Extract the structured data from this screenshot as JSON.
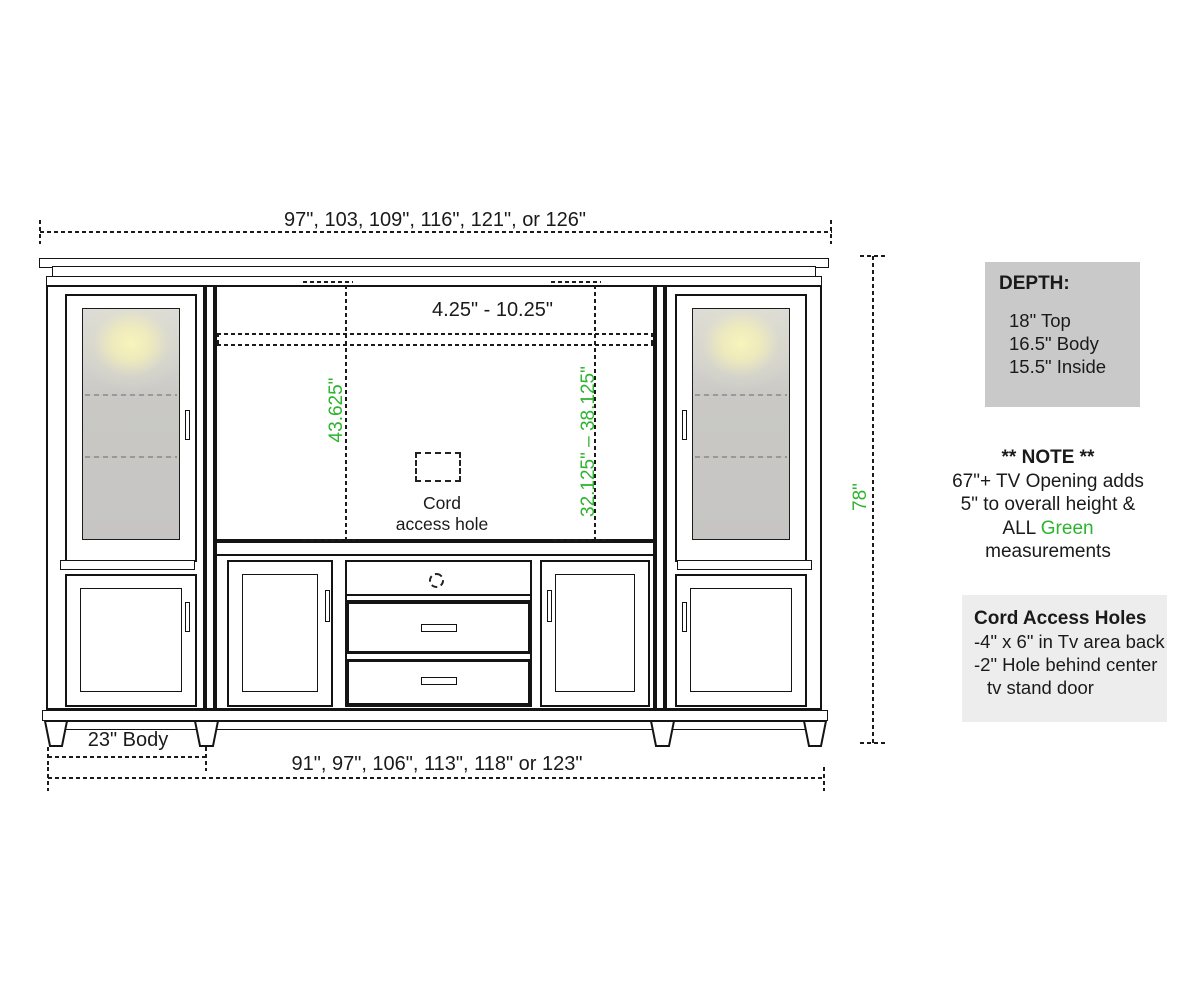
{
  "diagram": {
    "dim_top_width": "97\", 103, 109\", 116\", 121\", or 126\"",
    "dim_tv_opening": "4.25\" - 10.25\"",
    "dim_tv_height_left": "43.625\"",
    "dim_tv_height_right": "32.125\" – 38.125\"",
    "dim_overall_height": "78\"",
    "dim_body": "23\" Body",
    "dim_bottom_width": "91\", 97\", 106\", 113\", 118\" or 123\"",
    "cord_label_line1": "Cord",
    "cord_label_line2": "access hole"
  },
  "panel": {
    "depth": {
      "title": "DEPTH:",
      "items": [
        "18\" Top",
        "16.5\" Body",
        "15.5\" Inside"
      ]
    },
    "note": {
      "title": "** NOTE **",
      "line1": "67\"+ TV Opening adds",
      "line2": "5\" to overall height &",
      "line3_prefix": "ALL ",
      "line3_highlight": "Green",
      "line4": "measurements"
    },
    "cord_holes": {
      "title": "Cord Access Holes",
      "line1": "-4\" x 6\" in Tv area back",
      "line2": "-2\" Hole behind center",
      "line3": "tv stand door"
    }
  },
  "colors": {
    "green": "#2db42d",
    "depth_box_bg": "#c9c9c9",
    "cord_box_bg": "#ededed",
    "line": "#141414"
  }
}
